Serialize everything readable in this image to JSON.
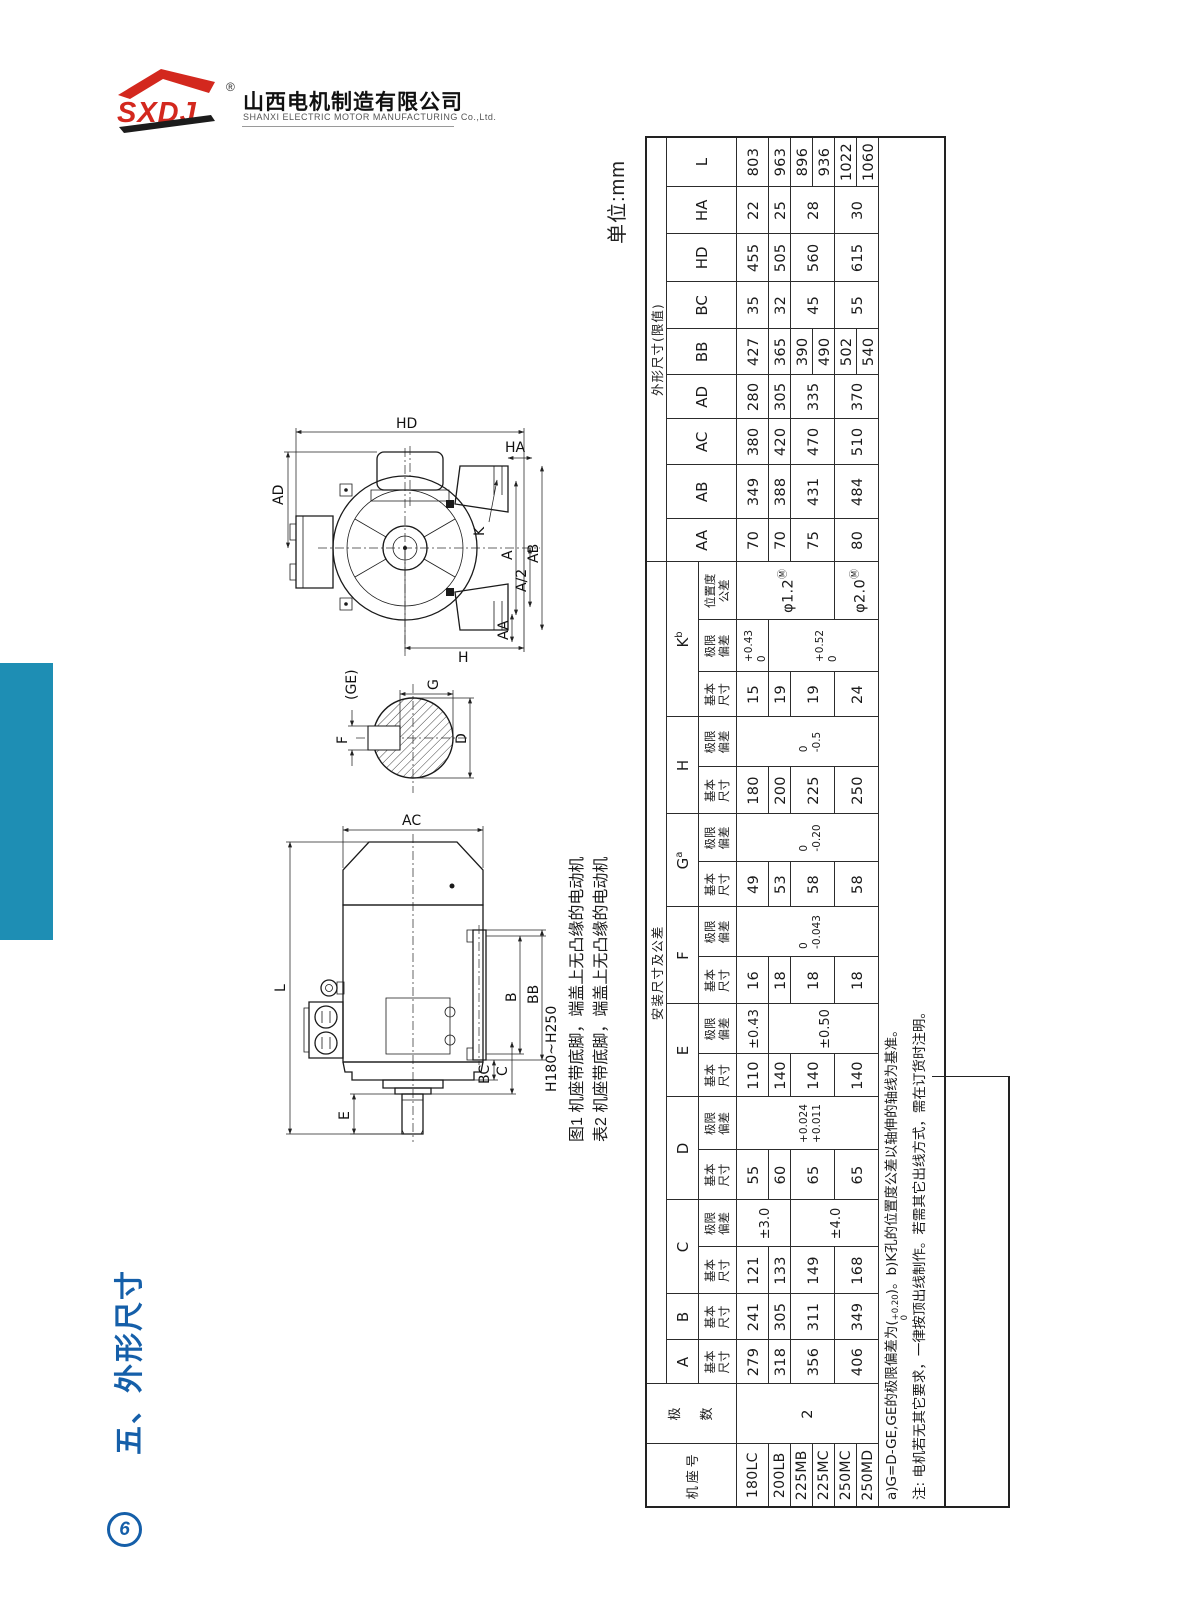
{
  "logo": {
    "mark_text": "SXDJ",
    "registered": "®",
    "company_cn": "山西电机制造有限公司",
    "company_en": "SHANXI ELECTRIC MOTOR MANUFACTURING Co.,Ltd.",
    "colors": {
      "logo_red": "#d3281e",
      "logo_black": "#1c1c1c"
    }
  },
  "sidebar": {
    "section_title": "五、外形尺寸",
    "page_number": "6",
    "accent_blue": "#155fa9",
    "bar_teal": "#1e8eb4"
  },
  "unit_label": "单位:mm",
  "drawings": {
    "fig_caption": "图1 机座带底脚，端盖上无凸缘的电动机",
    "table_caption": "表2 机座带底脚，端盖上无凸缘的电动机",
    "end_view": {
      "labels": {
        "AD": "AD",
        "HD": "HD",
        "HA": "HA",
        "K": "K",
        "A": "A",
        "AB": "AB",
        "A_half": "A/2",
        "AA": "AA",
        "H": "H"
      }
    },
    "shaft_section": {
      "labels": {
        "GE": "(GE)",
        "G": "G",
        "F": "F",
        "D": "D"
      }
    },
    "side_view": {
      "labels": {
        "AC": "AC",
        "L": "L",
        "B": "B",
        "BB": "BB",
        "C": "C",
        "BC": "BC",
        "E": "E"
      },
      "range_label": "H180~H250"
    }
  },
  "dim_table": {
    "headers": {
      "frame_no": "机座号",
      "poles": "极数",
      "install": "安装尺寸及公差",
      "outline": "外形尺寸(限值)",
      "basic": "基本\n尺寸",
      "deviation": "极限\n偏差",
      "position_tol": "位置度\n公差"
    },
    "install_groups": [
      {
        "letter": "A",
        "sup": "",
        "subs": [
          "basic"
        ]
      },
      {
        "letter": "B",
        "sup": "",
        "subs": [
          "basic"
        ]
      },
      {
        "letter": "C",
        "sup": "",
        "subs": [
          "basic",
          "deviation"
        ]
      },
      {
        "letter": "D",
        "sup": "",
        "subs": [
          "basic",
          "deviation"
        ]
      },
      {
        "letter": "E",
        "sup": "",
        "subs": [
          "basic",
          "deviation"
        ]
      },
      {
        "letter": "F",
        "sup": "",
        "subs": [
          "basic",
          "deviation"
        ]
      },
      {
        "letter": "G",
        "sup": "a",
        "subs": [
          "basic",
          "deviation"
        ]
      },
      {
        "letter": "H",
        "sup": "",
        "subs": [
          "basic",
          "deviation"
        ]
      },
      {
        "letter": "K",
        "sup": "b",
        "subs": [
          "basic",
          "deviation",
          "position_tol"
        ]
      }
    ],
    "outline_cols": [
      "AA",
      "AB",
      "AC",
      "AD",
      "BB",
      "BC",
      "HD",
      "HA",
      "L"
    ],
    "frames": [
      "180LC",
      "200LB",
      "225MB",
      "225MC",
      "250MC",
      "250MD"
    ],
    "poles_value": "2",
    "columns": [
      {
        "key": "A_basic",
        "cells": [
          {
            "t": "279"
          },
          {
            "t": "318"
          },
          {
            "t": "356",
            "span": 2
          },
          {
            "t": "406",
            "span": 2
          }
        ]
      },
      {
        "key": "B_basic",
        "cells": [
          {
            "t": "241"
          },
          {
            "t": "305"
          },
          {
            "t": "311",
            "span": 2
          },
          {
            "t": "349",
            "span": 2
          }
        ]
      },
      {
        "key": "C_basic",
        "cells": [
          {
            "t": "121"
          },
          {
            "t": "133"
          },
          {
            "t": "149",
            "span": 2
          },
          {
            "t": "168",
            "span": 2
          }
        ]
      },
      {
        "key": "C_dev",
        "cells": [
          {
            "t": "±3.0",
            "tol": true,
            "span": 2
          },
          {
            "t": "±4.0",
            "tol": true,
            "span": 4
          }
        ]
      },
      {
        "key": "D_basic",
        "cells": [
          {
            "t": "55"
          },
          {
            "t": "60"
          },
          {
            "t": "65",
            "span": 2
          },
          {
            "t": "65",
            "span": 2
          }
        ]
      },
      {
        "key": "D_dev",
        "cells": [
          {
            "u": "+0.024",
            "l": "+0.011",
            "span": 6
          }
        ]
      },
      {
        "key": "E_basic",
        "cells": [
          {
            "t": "110"
          },
          {
            "t": "140"
          },
          {
            "t": "140",
            "span": 2
          },
          {
            "t": "140",
            "span": 2
          }
        ]
      },
      {
        "key": "E_dev",
        "cells": [
          {
            "t": "±0.43",
            "tol": true
          },
          {
            "t": "±0.50",
            "tol": true,
            "span": 5
          }
        ]
      },
      {
        "key": "F_basic",
        "cells": [
          {
            "t": "16"
          },
          {
            "t": "18"
          },
          {
            "t": "18",
            "span": 2
          },
          {
            "t": "18",
            "span": 2
          }
        ]
      },
      {
        "key": "F_dev",
        "cells": [
          {
            "u": "0",
            "l": "-0.043",
            "span": 6
          }
        ]
      },
      {
        "key": "G_basic",
        "cells": [
          {
            "t": "49"
          },
          {
            "t": "53"
          },
          {
            "t": "58",
            "span": 2
          },
          {
            "t": "58",
            "span": 2
          }
        ]
      },
      {
        "key": "G_dev",
        "cells": [
          {
            "u": "0",
            "l": "-0.20",
            "span": 6
          }
        ]
      },
      {
        "key": "H_basic",
        "cells": [
          {
            "t": "180"
          },
          {
            "t": "200"
          },
          {
            "t": "225",
            "span": 2
          },
          {
            "t": "250",
            "span": 2
          }
        ]
      },
      {
        "key": "H_dev",
        "cells": [
          {
            "u": "0",
            "l": "-0.5",
            "span": 6
          }
        ]
      },
      {
        "key": "K_basic",
        "cells": [
          {
            "t": "15"
          },
          {
            "t": "19"
          },
          {
            "t": "19",
            "span": 2
          },
          {
            "t": "24",
            "span": 2
          }
        ]
      },
      {
        "key": "K_dev",
        "cells": [
          {
            "u": "+0.43",
            "l": "0"
          },
          {
            "u": "+0.52",
            "l": "0",
            "span": 5
          }
        ]
      },
      {
        "key": "K_pos",
        "cells": [
          {
            "t": "φ1.2",
            "sup": "Ⓜ",
            "span": 4
          },
          {
            "t": "φ2.0",
            "sup": "Ⓜ",
            "span": 2
          }
        ]
      },
      {
        "key": "AA",
        "cells": [
          {
            "t": "70"
          },
          {
            "t": "70"
          },
          {
            "t": "75",
            "span": 2
          },
          {
            "t": "80",
            "span": 2
          }
        ]
      },
      {
        "key": "AB",
        "cells": [
          {
            "t": "349"
          },
          {
            "t": "388"
          },
          {
            "t": "431",
            "span": 2
          },
          {
            "t": "484",
            "span": 2
          }
        ]
      },
      {
        "key": "AC",
        "cells": [
          {
            "t": "380"
          },
          {
            "t": "420"
          },
          {
            "t": "470",
            "span": 2
          },
          {
            "t": "510",
            "span": 2
          }
        ]
      },
      {
        "key": "AD",
        "cells": [
          {
            "t": "280"
          },
          {
            "t": "305"
          },
          {
            "t": "335",
            "span": 2
          },
          {
            "t": "370",
            "span": 2
          }
        ]
      },
      {
        "key": "BB",
        "cells": [
          {
            "t": "427"
          },
          {
            "t": "365"
          },
          {
            "t": "390"
          },
          {
            "t": "490"
          },
          {
            "t": "502"
          },
          {
            "t": "540"
          }
        ]
      },
      {
        "key": "BC",
        "cells": [
          {
            "t": "35"
          },
          {
            "t": "32"
          },
          {
            "t": "45",
            "span": 2
          },
          {
            "t": "55",
            "span": 2
          }
        ]
      },
      {
        "key": "HD",
        "cells": [
          {
            "t": "455"
          },
          {
            "t": "505"
          },
          {
            "t": "560",
            "span": 2
          },
          {
            "t": "615",
            "span": 2
          }
        ]
      },
      {
        "key": "HA",
        "cells": [
          {
            "t": "22"
          },
          {
            "t": "25"
          },
          {
            "t": "28",
            "span": 2
          },
          {
            "t": "30",
            "span": 2
          }
        ]
      },
      {
        "key": "L",
        "cells": [
          {
            "t": "803"
          },
          {
            "t": "963"
          },
          {
            "t": "896"
          },
          {
            "t": "936"
          },
          {
            "t": "1022"
          },
          {
            "t": "1060"
          }
        ]
      }
    ],
    "note_a": {
      "pre": "a)G=D-GE,GE的极限偏差为(",
      "upper": "+0.20",
      "lower": "0",
      "post": ")。b)K孔的位置度公差以轴伸的轴线为基准。"
    },
    "note_b": "注: 电机若无其它要求，一律按顶出线制作。若需其它出线方式，需在订货时注明。"
  }
}
